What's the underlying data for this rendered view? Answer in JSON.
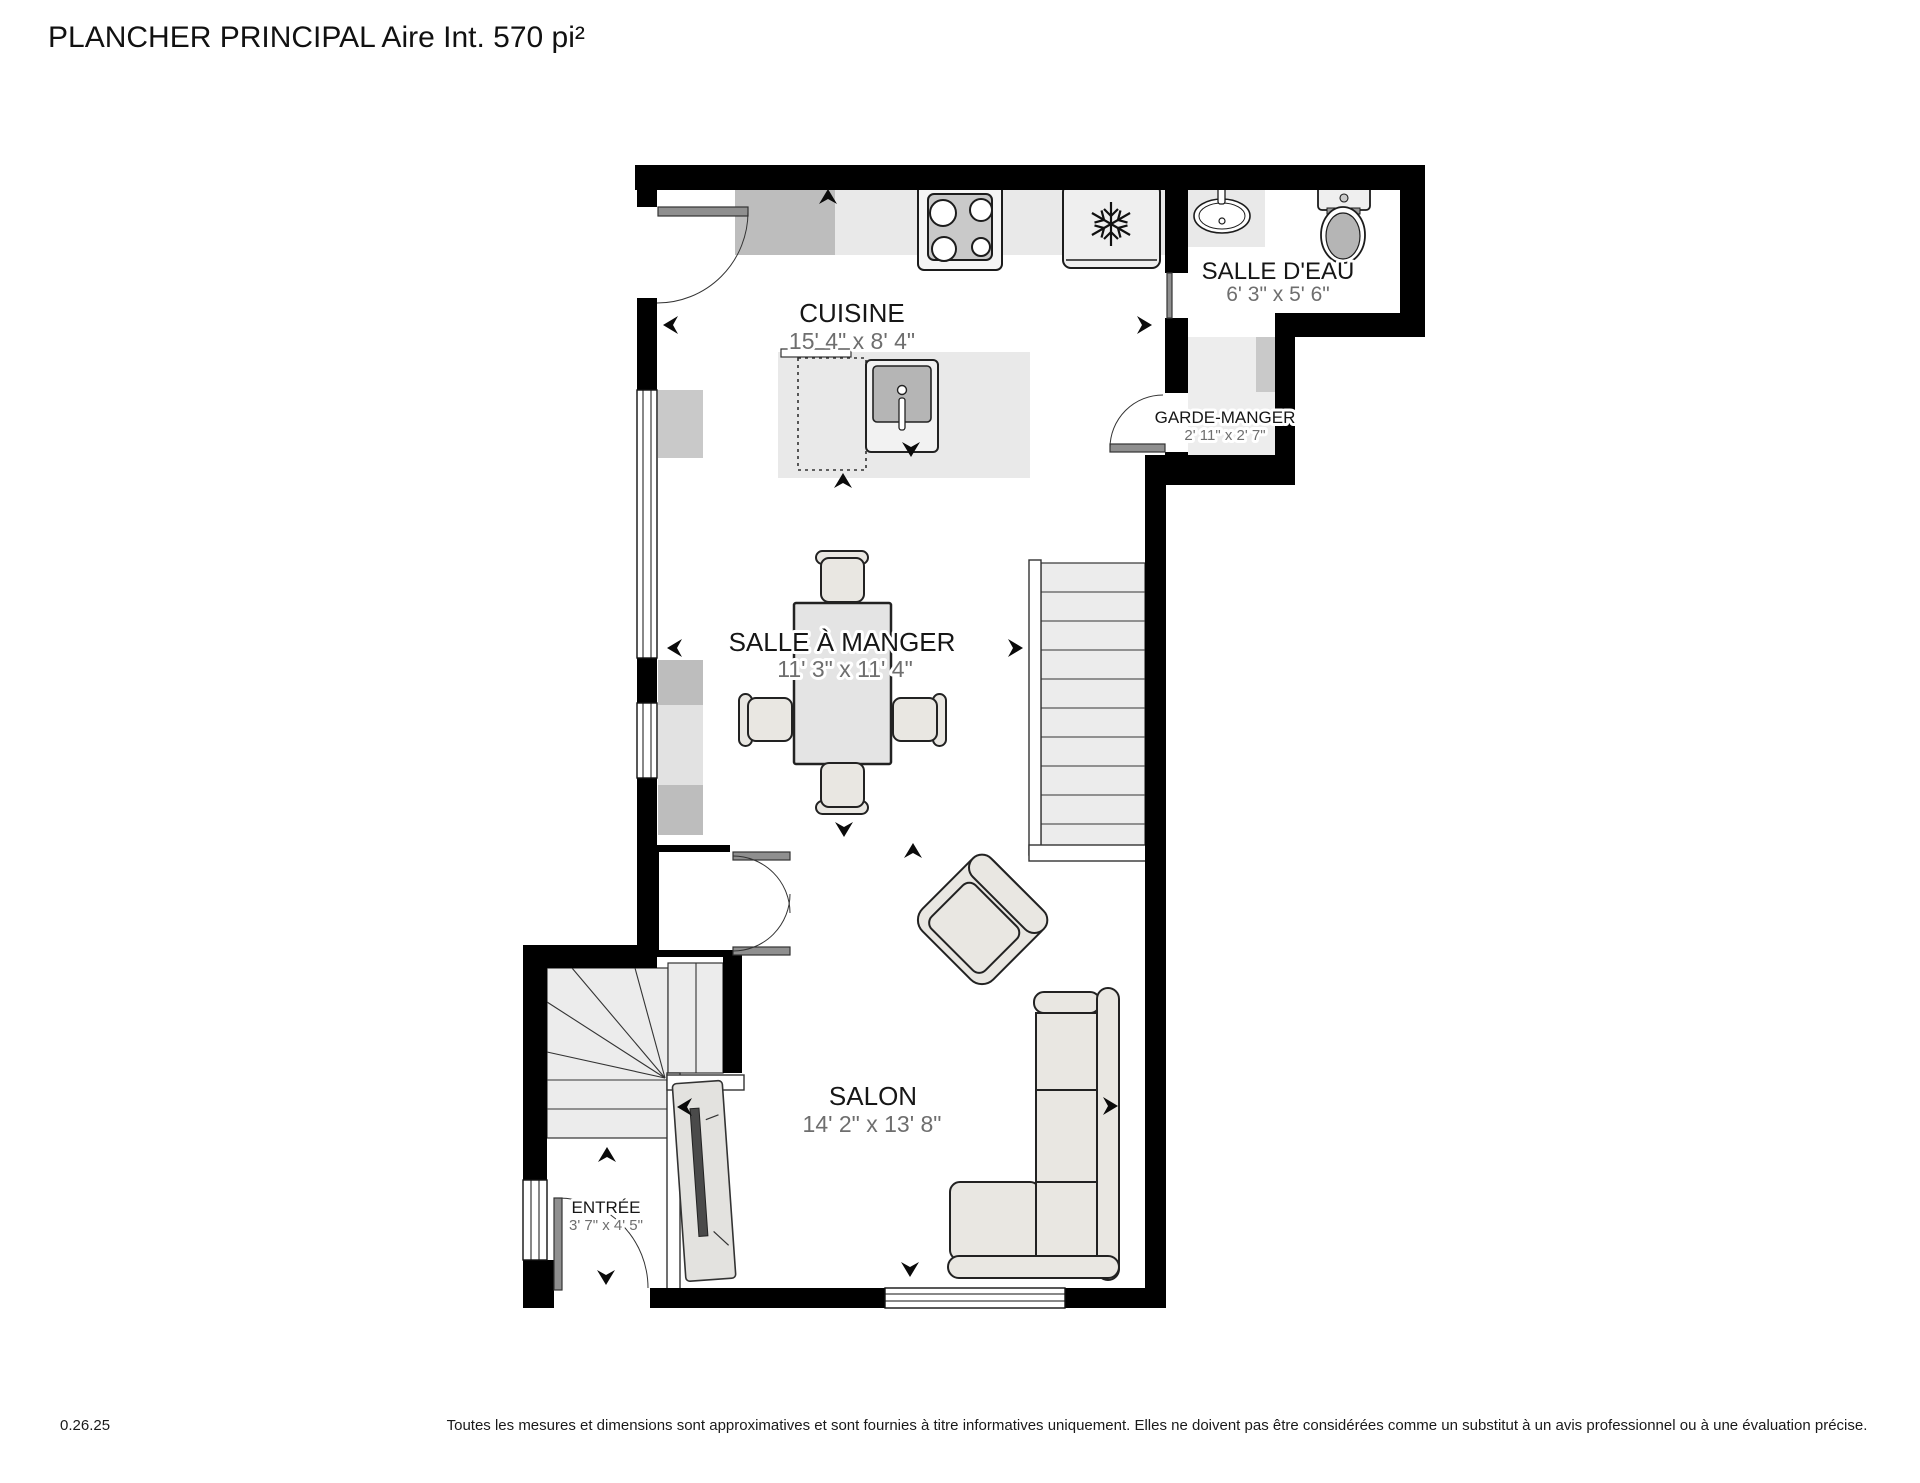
{
  "title": "PLANCHER PRINCIPAL Aire Int. 570 pi²",
  "rooms": [
    {
      "name": "CUISINE",
      "dims": "15' 4\" x 8' 4\""
    },
    {
      "name": "SALLE D'EAU",
      "dims": "6' 3\" x 5' 6\""
    },
    {
      "name": "GARDE-MANGER",
      "dims": "2' 11\" x 2' 7\""
    },
    {
      "name": "SALLE À MANGER",
      "dims": "11' 3\" x 11' 4\""
    },
    {
      "name": "SALON",
      "dims": "14' 2\" x 13' 8\""
    },
    {
      "name": "ENTRÉE",
      "dims": "3' 7\" x 4' 5\""
    }
  ],
  "footer": {
    "version": "0.26.25",
    "disclaimer": "Toutes les mesures et dimensions sont approximatives et sont fournies à titre informatives uniquement. Elles ne doivent pas être considérées comme un substitut à un avis professionnel ou à une évaluation précise."
  },
  "colors": {
    "wall": "#000000",
    "counter": "#e9e9e9",
    "dims_text": "#6e6e6e",
    "floor": "#ffffff"
  }
}
